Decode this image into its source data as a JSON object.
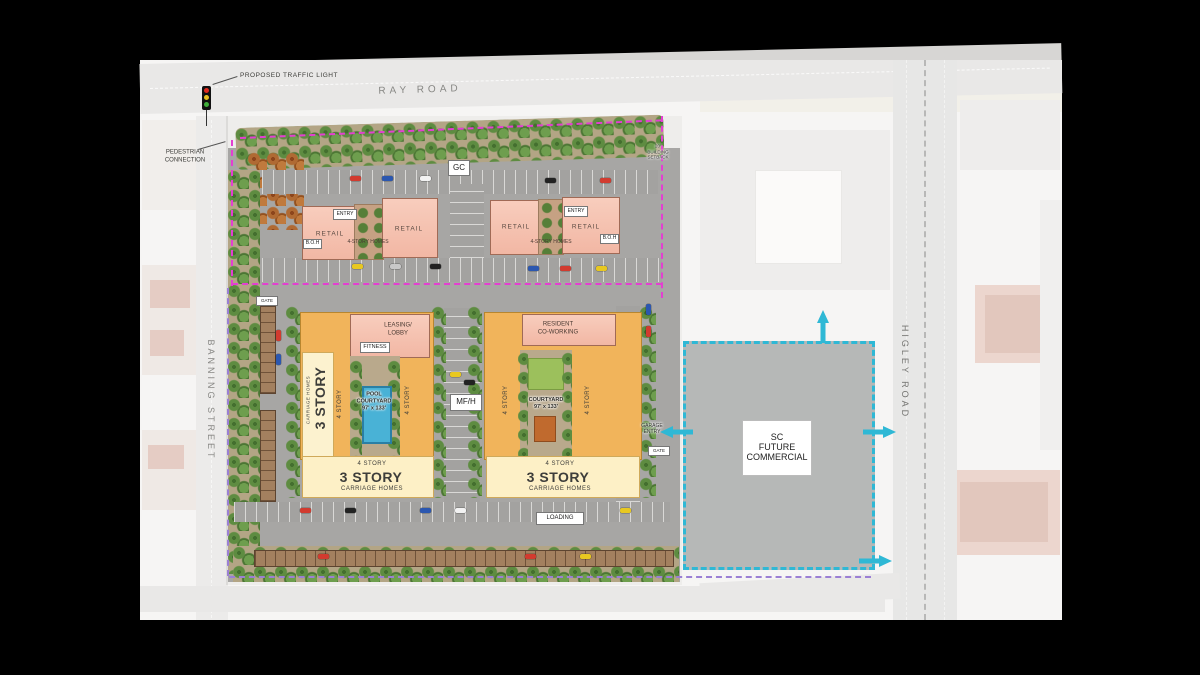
{
  "colors": {
    "boundary_magenta": "#e33fd1",
    "boundary_purple": "#9b7fd4",
    "parcel_cyan": "#2fb8d5",
    "retail_pink": "#f5c1b0",
    "residential_gold": "#f1b45b",
    "pool_blue": "#49b2d6",
    "future_commercial_gray": "#b6b8b7"
  },
  "roads": {
    "ray": "RAY ROAD",
    "banning": "BANNING STREET",
    "higley": "HIGLEY ROAD"
  },
  "callouts": {
    "traffic_light": "PROPOSED TRAFFIC LIGHT",
    "pedestrian": "PEDESTRIAN\nCONNECTION",
    "setback": "20'\nBUILDING\nSETBACK",
    "gc": "GC",
    "mfh": "MF/H",
    "loading": "LOADING",
    "garage_entry": "GARAGE\nENTRY",
    "gate": "GATE"
  },
  "mixed_use": [
    {
      "entry": "ENTRY",
      "retail_a": "RETAIL",
      "retail_b": "RETAIL",
      "boh": "B.O.H",
      "upper": "4-STORY HOMES"
    },
    {
      "entry": "ENTRY",
      "retail_a": "RETAIL",
      "retail_b": "RETAIL",
      "boh": "B.O.H",
      "upper": "4-STORY HOMES"
    }
  ],
  "residential_west": {
    "leasing": "LEASING/\nLOBBY",
    "fitness": "FITNESS",
    "pool": "POOL\nCOURTYARD\n97' x 133'",
    "four_story": "4 STORY",
    "three_story": "3 STORY",
    "carriage_homes": "CARRIAGE HOMES"
  },
  "residential_east": {
    "coworking": "RESIDENT\nCO-WORKING",
    "courtyard": "COURTYARD\n97' x 133'",
    "four_story": "4 STORY",
    "three_story": "3 STORY",
    "carriage_homes": "CARRIAGE HOMES"
  },
  "future_commercial": {
    "label": "SC\nFUTURE\nCOMMERCIAL"
  }
}
